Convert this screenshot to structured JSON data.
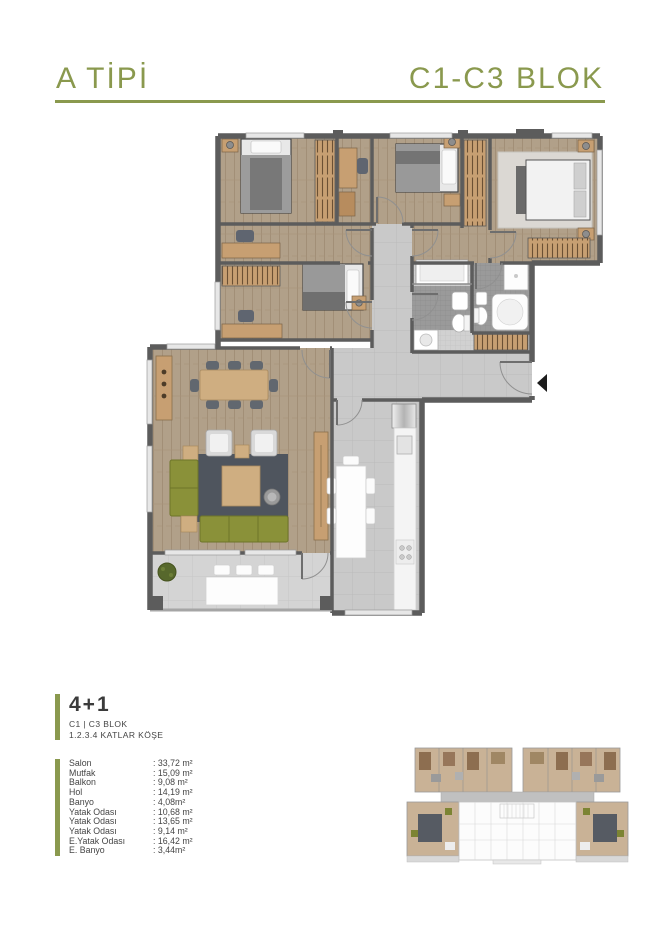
{
  "header": {
    "type_label": "A TİPİ",
    "block_label": "C1-C3 BLOK",
    "accent_color": "#8a994e"
  },
  "unit": {
    "layout_label": "4+1",
    "block_info": "C1 | C3 BLOK",
    "floor_info": "1.2.3.4 KATLAR KÖŞE"
  },
  "room_list": [
    {
      "name": "Salon",
      "area": ": 33,72 m²"
    },
    {
      "name": "Mutfak",
      "area": ": 15,09 m²"
    },
    {
      "name": "Balkon",
      "area": ": 9,08 m²"
    },
    {
      "name": "Hol",
      "area": ": 14,19 m²"
    },
    {
      "name": "Banyo",
      "area": ": 4,08m²"
    },
    {
      "name": "Yatak Odası",
      "area": ": 10,68 m²"
    },
    {
      "name": "Yatak Odası",
      "area": ": 13,65 m²"
    },
    {
      "name": "Yatak Odası",
      "area": ": 9,14 m²"
    },
    {
      "name": "E.Yatak Odası",
      "area": ": 16,42 m²"
    },
    {
      "name": "E. Banyo",
      "area": ": 3,44m²"
    }
  ],
  "floorplan": {
    "type": "apartment-floor-plan",
    "colors": {
      "wall": "#5c5c5c",
      "wood_floor": "#b1a089",
      "tile_floor": "#c9c9c9",
      "balcony_tile": "#d4d4d4",
      "bath_mosaic": "#9a9a9a",
      "wardrobe_wood": "#c79f72",
      "sofa_olive": "#8a9139",
      "rug_slate": "#4f555e",
      "dining_wood": "#cfae81",
      "plant_green": "#57682c"
    }
  }
}
